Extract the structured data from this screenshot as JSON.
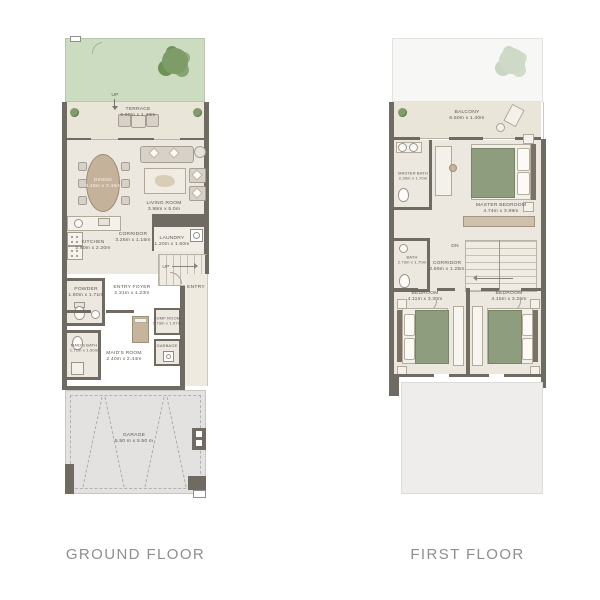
{
  "captions": {
    "ground_floor": "GROUND FLOOR",
    "first_floor": "FIRST FLOOR"
  },
  "ground_floor": {
    "terrace": {
      "name": "TERRACE",
      "dims": "6.50m x 1.43m"
    },
    "dining": {
      "name": "DINING",
      "dims": "3.48m x 3.46m"
    },
    "living_room": {
      "name": "LIVING ROOM",
      "dims": "3.98m x 5.0m"
    },
    "kitchen": {
      "name": "KITCHEN",
      "dims": "2.80m x 2.20m"
    },
    "corridor": {
      "name": "CORRIDOR",
      "dims": "3.26m x 1.15m"
    },
    "laundry": {
      "name": "LAUNDRY",
      "dims": "1.20m x 1.60m"
    },
    "entry_foyer": {
      "name": "ENTRY FOYER",
      "dims": "2.31m x 1.23m"
    },
    "entry": {
      "name": "ENTRY"
    },
    "powder": {
      "name": "POWDER",
      "dims": "1.80m x 1.71m"
    },
    "maids_bath": {
      "name": "MAID'S BATH",
      "dims": "1.71m x 1.50m"
    },
    "maids_room": {
      "name": "MAID'S ROOM",
      "dims": "2.40m x 2.44m"
    },
    "pump_room": {
      "name": "PUMP ROOM",
      "dims": "0.73m x 1.07m"
    },
    "garbage": {
      "name": "GARBAGE"
    },
    "garage": {
      "name": "GARAGE",
      "dims": "5.50 m x 5.50 m"
    },
    "stairs_label": "UP",
    "step_label": "UP"
  },
  "first_floor": {
    "balcony": {
      "name": "BALCONY",
      "dims": "6.50m x 1.40m"
    },
    "master_bath": {
      "name": "MASTER BATH",
      "dims": "2.30m x 1.70m"
    },
    "master_bedroom": {
      "name": "MASTER BEDROOM",
      "dims": "4.74m x 3.99m"
    },
    "bath": {
      "name": "BATH",
      "dims": "2.73m x 1.70m"
    },
    "corridor": {
      "name": "CORRIDOR",
      "dims": "2.69m x 1.25m"
    },
    "bedroom_left": {
      "name": "BEDROOM",
      "dims": "4.11m x 3.30m"
    },
    "bedroom_right": {
      "name": "BEDROOM",
      "dims": "4.15m x 3.26m"
    },
    "stairs_label": "DN"
  },
  "colors": {
    "garden_green": "#cbdcc1",
    "wall_gray": "#6f6a62",
    "interior_floor": "#ece8e0",
    "terrace_floor": "#eae5d9",
    "bed_blanket_green": "#8d9d7e",
    "wood_tan": "#c6b49c",
    "garage_floor": "#e3e2e0",
    "caption_gray": "#8e8e8e"
  }
}
